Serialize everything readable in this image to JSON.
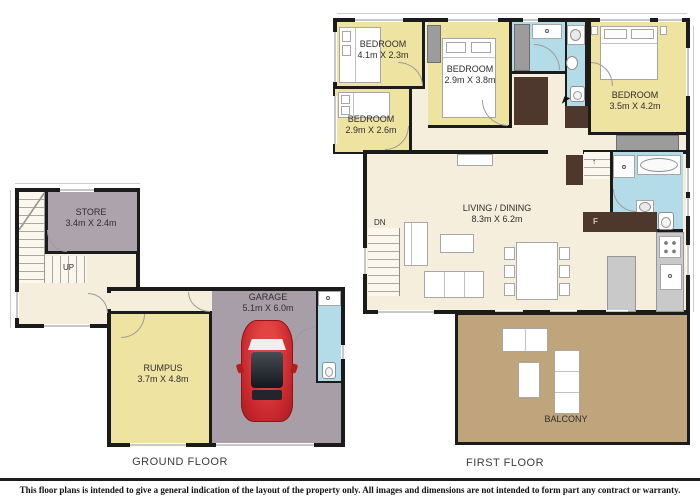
{
  "palette": {
    "wall": "#1b1b1b",
    "floor_cream": "#f6eedd",
    "room_yellow": "#efe3a2",
    "room_gray": "#a89ea8",
    "store_gray": "#aca3ad",
    "bath_blue": "#b3dce8",
    "closet_brown": "#4e372c",
    "balcony_tan": "#bfa47c",
    "car_red": "#c7272c"
  },
  "ground_floor": {
    "title": "GROUND FLOOR",
    "store": {
      "name": "STORE",
      "dims": "3.4m X 2.4m"
    },
    "rumpus": {
      "name": "RUMPUS",
      "dims": "3.7m X 4.8m"
    },
    "garage": {
      "name": "GARAGE",
      "dims": "5.1m X 6.0m"
    },
    "stair_direction": "UP"
  },
  "first_floor": {
    "title": "FIRST FLOOR",
    "bedroom_top_left": {
      "name": "BEDROOM",
      "dims": "4.1m X 2.3m"
    },
    "bedroom_mid": {
      "name": "BEDROOM",
      "dims": "2.9m X 3.8m"
    },
    "bedroom_bottom_left": {
      "name": "BEDROOM",
      "dims": "2.9m X 2.6m"
    },
    "bedroom_right": {
      "name": "BEDROOM",
      "dims": "3.5m X 4.2m"
    },
    "living_dining": {
      "name": "LIVING / DINING",
      "dims": "8.3m X 6.2m"
    },
    "balcony": {
      "name": "BALCONY"
    },
    "stair_direction": "DN",
    "fridge_label": "F"
  },
  "footer": {
    "disclaimer": "This floor plans is intended to give a general indication of the layout of the property only. All images and dimensions are not intended to form part any contract or warranty."
  }
}
